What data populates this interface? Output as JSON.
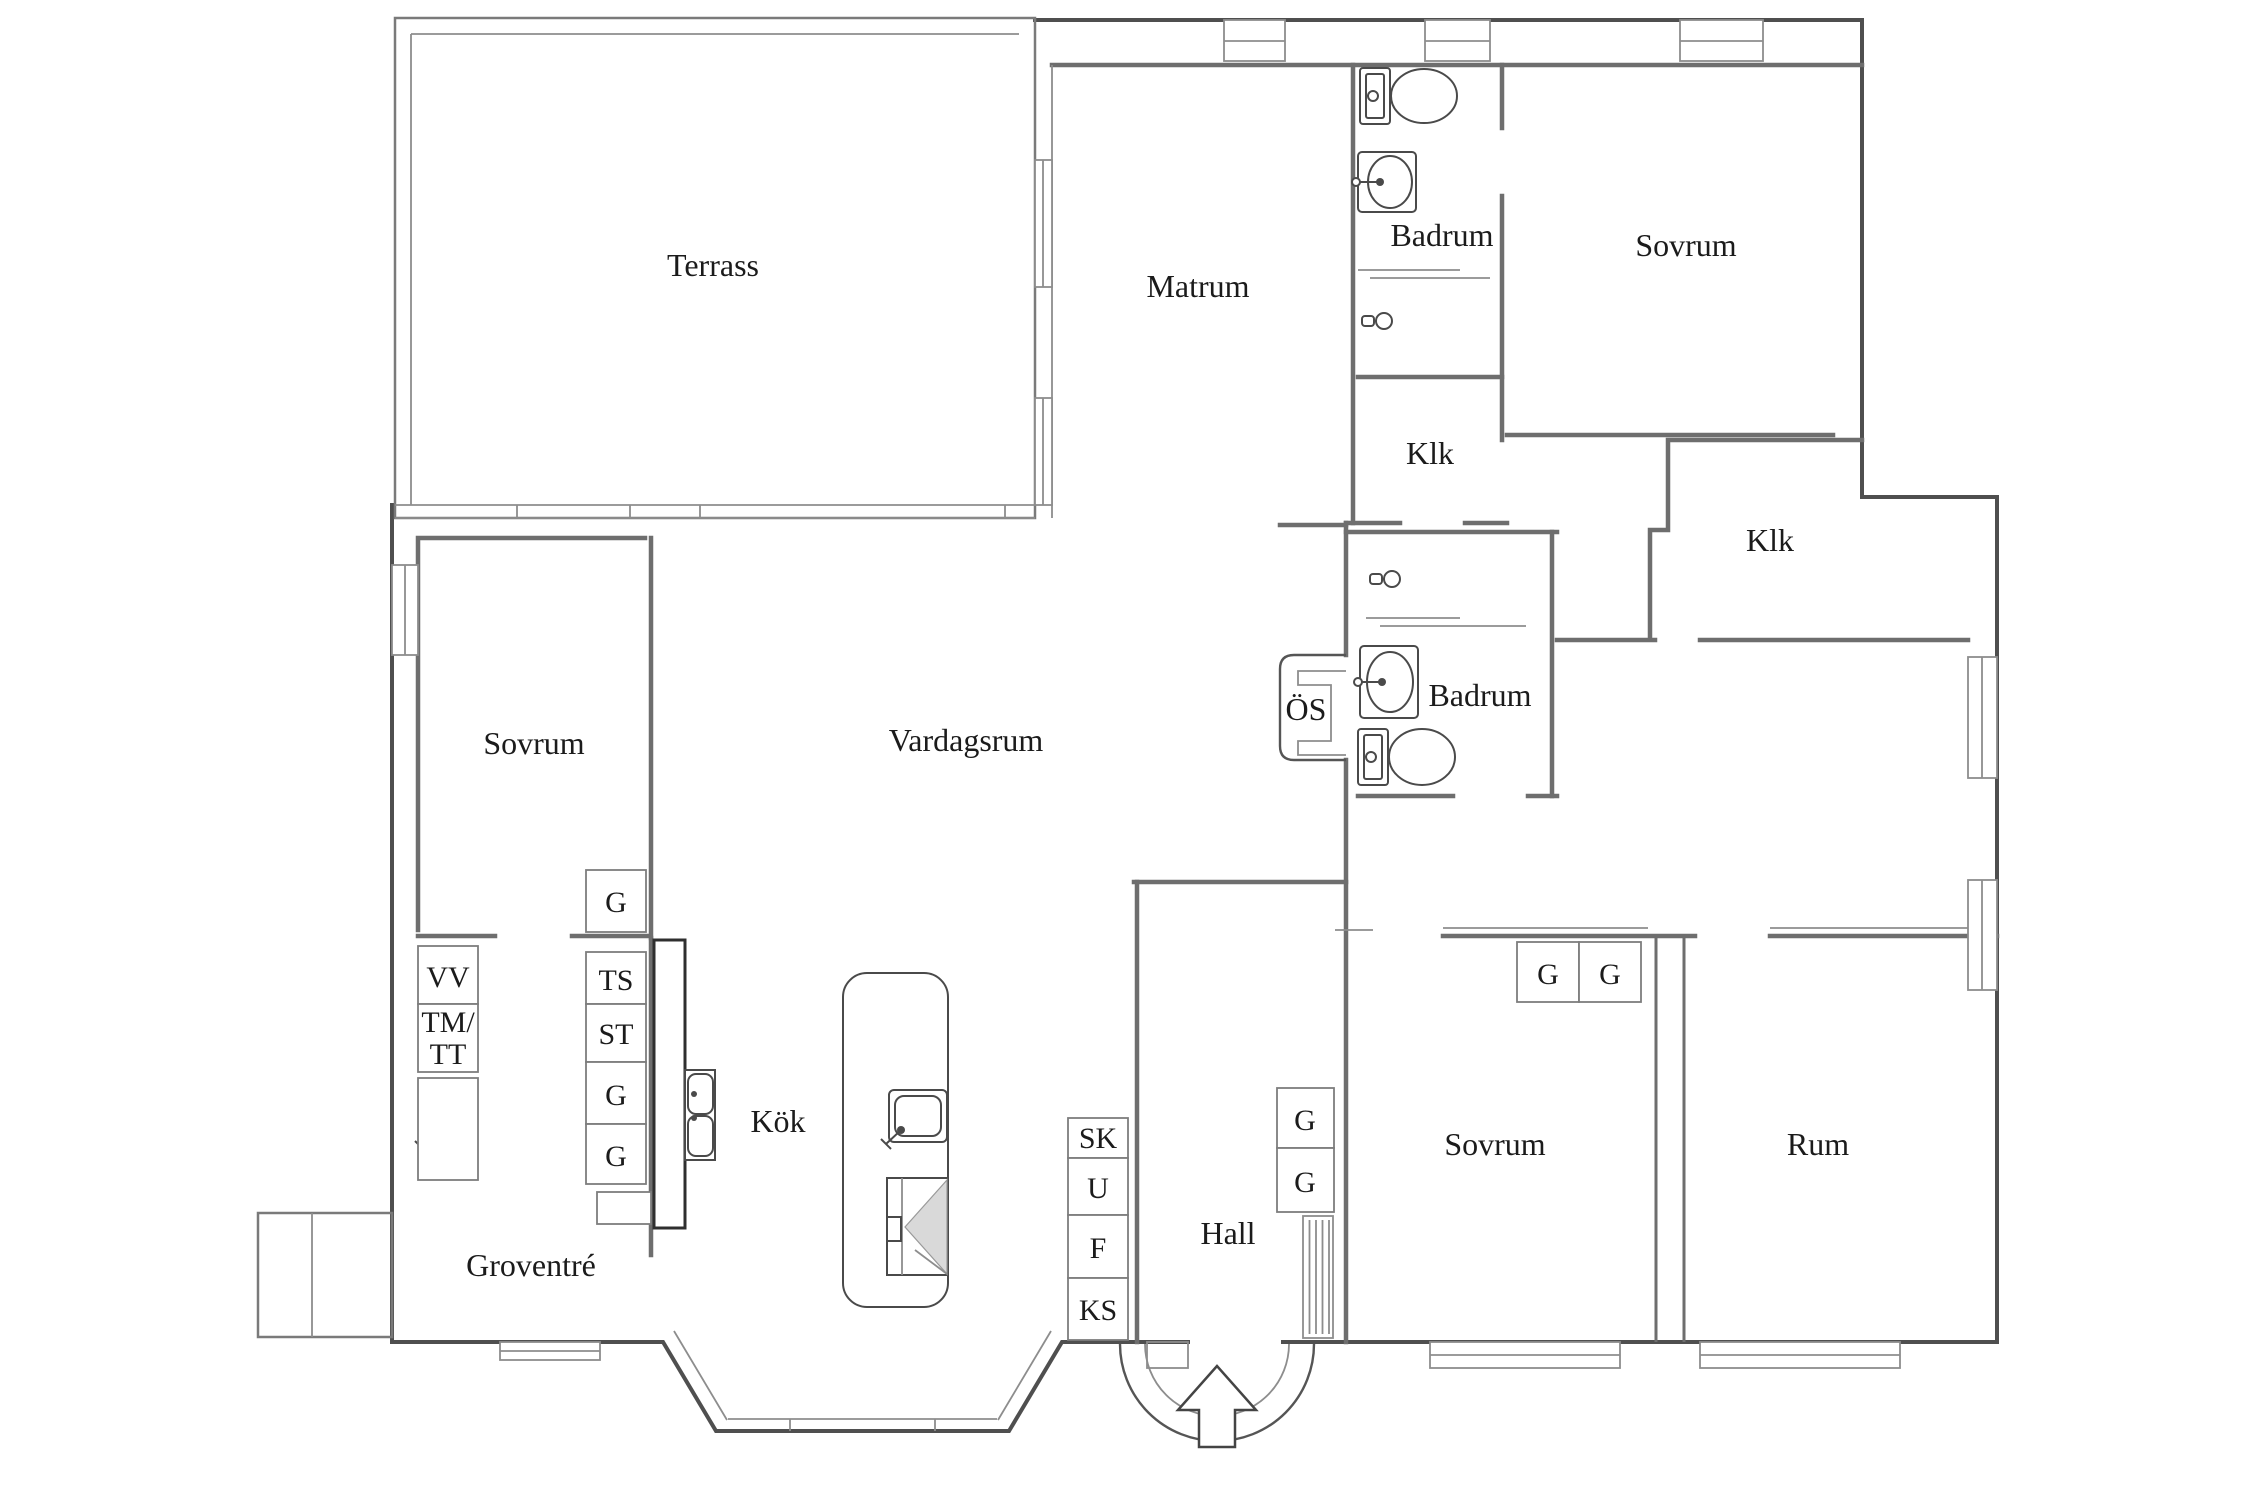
{
  "rooms": {
    "terrass": "Terrass",
    "matrum": "Matrum",
    "badrum_top": "Badrum",
    "sovrum_top": "Sovrum",
    "klk_top": "Klk",
    "klk_right": "Klk",
    "sovrum_left": "Sovrum",
    "vardagsrum": "Vardagsrum",
    "os": "ÖS",
    "badrum_mid": "Badrum",
    "kok": "Kök",
    "hall": "Hall",
    "groventre": "Groventré",
    "sovrum_bottom": "Sovrum",
    "rum": "Rum"
  },
  "storage": {
    "g_a": "G",
    "ts": "TS",
    "st": "ST",
    "g_b": "G",
    "g_c": "G",
    "vv": "VV",
    "tm": "TM/",
    "tt": "TT",
    "sk": "SK",
    "u": "U",
    "f": "F",
    "ks": "KS",
    "hall_g1": "G",
    "hall_g2": "G",
    "sovrum_g1": "G",
    "sovrum_g2": "G"
  },
  "icons": {
    "toilet_top": "toilet-icon",
    "toilet_mid": "toilet-icon",
    "sink_badrum_top": "sink-icon",
    "sink_badrum_mid": "sink-icon",
    "sink_laundry": "sink-icon",
    "sink_kitchen_double": "double-sink-icon",
    "sink_island": "sink-icon",
    "shower_top": "shower-head-icon",
    "shower_mid": "shower-head-icon",
    "radiator": "radiator-icon",
    "entrance": "entrance-arrow-icon",
    "stove": "stove-icon"
  },
  "colors": {
    "background": "#ffffff",
    "wall_outer": "#4f4f4f",
    "wall_inner": "#6e6e6e",
    "thin_line": "#8d8d8d",
    "counter": "#2f2f2f",
    "text": "#1b1b1b",
    "stove_fill": "#d9d9d9"
  }
}
